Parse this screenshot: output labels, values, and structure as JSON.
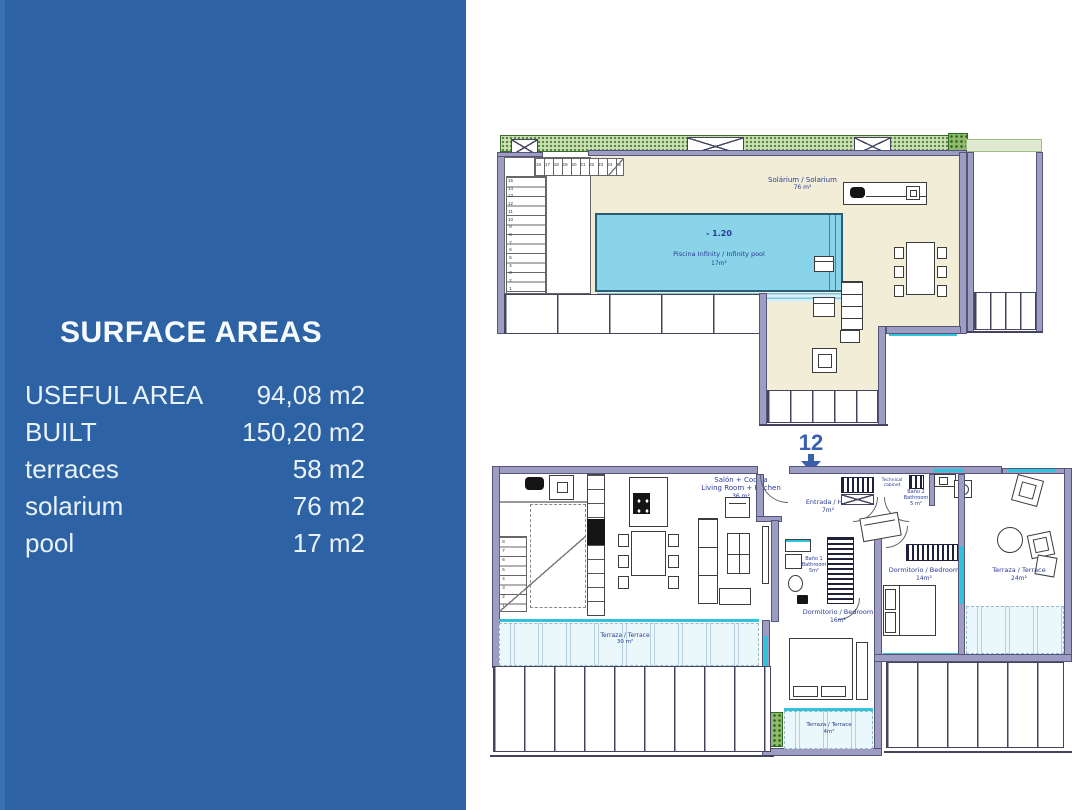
{
  "colors": {
    "panel_blue": "#2d63a5",
    "wall_lavender": "#9d9dc4",
    "solarium_cream": "#f1edd6",
    "pool_blue": "#8ad4ea",
    "glass_cyan": "#2fc3dc",
    "terrace_tint": "#eaf7fb",
    "greenery": "#4f8a3c",
    "label_navy": "#2b3a94",
    "marker_blue": "#3a5fae"
  },
  "sidebar": {
    "title": "SURFACE AREAS",
    "rows": [
      {
        "label": "USEFUL AREA",
        "value": "94,08 m2"
      },
      {
        "label": "BUILT",
        "value": "150,20 m2"
      },
      {
        "label": "terraces",
        "value": "58 m2"
      },
      {
        "label": "solarium",
        "value": "76 m2"
      },
      {
        "label": "pool",
        "value": "17 m2"
      }
    ]
  },
  "marker": {
    "number": "12"
  },
  "solarium_plan": {
    "solarium_label": {
      "line1": "Solárium / Solarium",
      "line2": "76 m²"
    },
    "pool": {
      "depth": "- 1.20",
      "name": "Piscina  Infinity  /  Infinity  pool",
      "area": "17m²"
    },
    "stairs": {
      "upper_numbers": [
        "16",
        "17",
        "18",
        "19",
        "20",
        "21",
        "22",
        "23",
        "24",
        "25"
      ],
      "lower_numbers": [
        "15",
        "14",
        "13",
        "12",
        "11",
        "10",
        "9",
        "8",
        "7",
        "6",
        "5",
        "4",
        "3",
        "2",
        "1"
      ]
    }
  },
  "floor_plan": {
    "living": {
      "line1": "Salón + Cocina",
      "line2": "Living  Room + Kitchen",
      "line3": "36 m²"
    },
    "hall": {
      "line1": "Entrada  /  Hall",
      "line2": "7m²"
    },
    "technical_cabinet": {
      "line1": "Technical",
      "line2": "cabinet"
    },
    "bathroom1": {
      "line1": "Baño  1",
      "line2": "Bathroom",
      "line3": "5m²"
    },
    "bathroom2": {
      "line1": "Baño  2",
      "line2": "Bathroom",
      "line3": "5 m²"
    },
    "bedroom1": {
      "line1": "Dormitorio  /  Bedroom",
      "line2": "16m²"
    },
    "bedroom2": {
      "line1": "Dormitorio  /  Bedroom",
      "line2": "14m²"
    },
    "terrace_right": {
      "line1": "Terraza  /  Terrace",
      "line2": "24m²"
    },
    "terrace_bottom": {
      "line1": "Terraza  /  Terrace",
      "line2": "30 m²"
    },
    "terrace_small": {
      "line1": "Terraza  /  Terrace",
      "line2": "4m²"
    },
    "stairs_numbers": [
      "8",
      "7",
      "6",
      "5",
      "4",
      "3",
      "2",
      "1"
    ]
  }
}
